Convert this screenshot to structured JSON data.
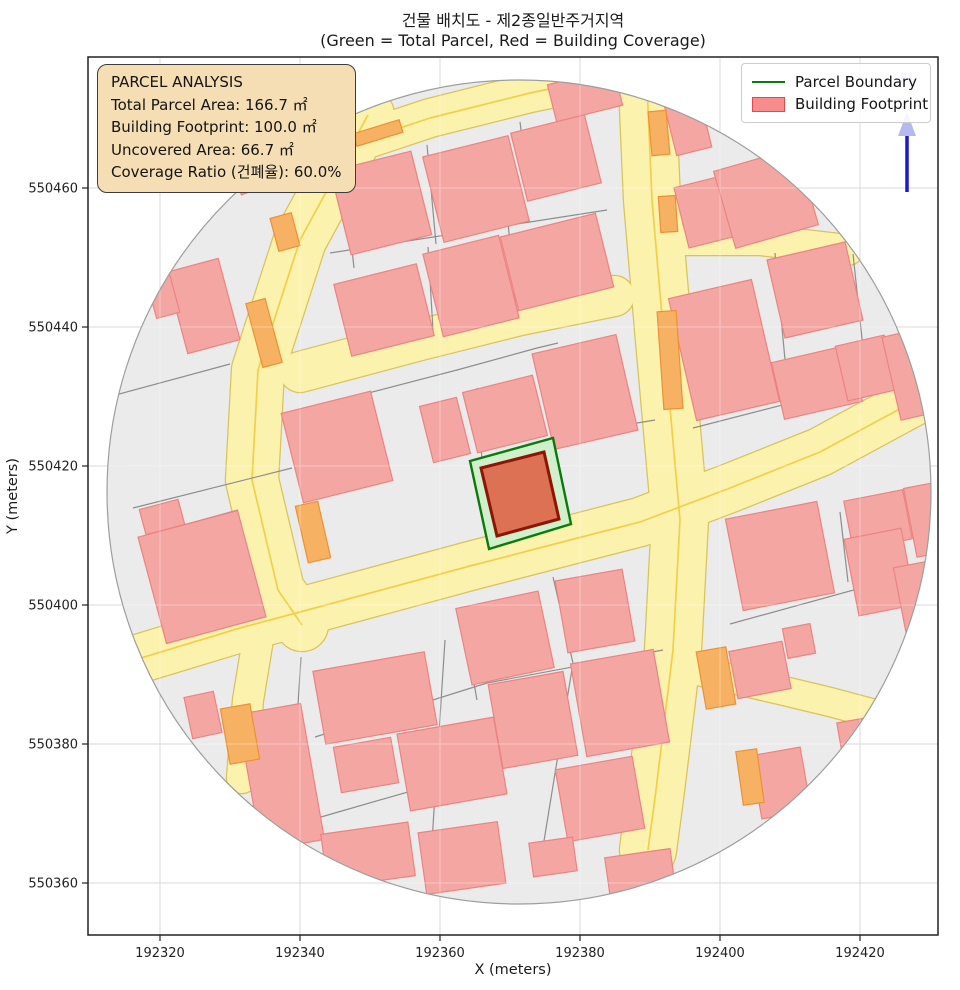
{
  "title": {
    "line1": "건물 배치도 - 제2종일반주거지역",
    "line2": "(Green = Total Parcel, Red = Building Coverage)"
  },
  "info_box": {
    "lines": [
      "PARCEL ANALYSIS",
      "Total Parcel Area: 166.7 ㎡",
      "Building Footprint: 100.0 ㎡",
      "Uncovered Area: 66.7 ㎡",
      "Coverage Ratio (건폐율): 60.0%"
    ]
  },
  "legend": {
    "items": [
      {
        "label": "Parcel Boundary",
        "type": "line",
        "color": "#0a7d0a"
      },
      {
        "label": "Building Footprint",
        "type": "patch",
        "fill": "#f88b8b",
        "stroke": "#e04b4b"
      }
    ]
  },
  "axes": {
    "xlabel": "X (meters)",
    "ylabel": "Y (meters)",
    "x_ticks": [
      192320,
      192340,
      192360,
      192380,
      192400,
      192420
    ],
    "y_ticks": [
      550360,
      550380,
      550400,
      550420,
      550440,
      550460
    ]
  },
  "north": {
    "label": "N"
  },
  "chart_data": {
    "type": "map",
    "title": "건물 배치도 - 제2종일반주거지역",
    "subtitle": "(Green = Total Parcel, Red = Building Coverage)",
    "xlabel": "X (meters)",
    "ylabel": "Y (meters)",
    "x_range": [
      192310,
      192431
    ],
    "y_range": [
      550353,
      550479
    ],
    "grid": true,
    "legend_position": "upper right",
    "zoning": "제2종일반주거지역",
    "parcel_analysis": {
      "total_parcel_area_m2": 166.7,
      "building_footprint_m2": 100.0,
      "uncovered_area_m2": 66.7,
      "coverage_ratio_pct": 60.0
    },
    "layers": [
      "buffer circle",
      "roads",
      "cadastral parcels",
      "building footprints",
      "highlighted parcel (green)",
      "highlighted building (red)",
      "north arrow"
    ]
  },
  "map": {
    "colors": {
      "circle_fill": "#ebebeb",
      "circle_edge": "#9e9e9e",
      "road_fill": "#fbf2ad",
      "road_edge": "#d9c35b",
      "road_centerline": "#f3cf49",
      "parcel_line": "#8d8d8d",
      "building_fill": "#f4a6a3",
      "building_edge": "#ec8381",
      "orange_fill": "#f7b163",
      "orange_edge": "#ec9134",
      "parcel_green_fill": "#cff0cb",
      "parcel_green_edge": "#0b7a0b",
      "footprint_fill": "#dc7154",
      "footprint_edge": "#8e1506",
      "grid": "#d9d9d9",
      "north_arrow": "#1a1acc",
      "north_text": "#b4baee",
      "spine": "#222222"
    },
    "circle": {
      "cx": 519,
      "cy": 492,
      "r": 412
    },
    "roads": [
      {
        "w": 38,
        "pts": [
          [
            340,
            148
          ],
          [
            430,
            118
          ],
          [
            530,
            93
          ],
          [
            640,
            70
          ]
        ]
      },
      {
        "w": 52,
        "pts": [
          [
            368,
            115
          ],
          [
            300,
            240
          ],
          [
            258,
            370
          ],
          [
            252,
            480
          ],
          [
            278,
            590
          ],
          [
            302,
            625
          ]
        ]
      },
      {
        "w": 30,
        "pts": [
          [
            262,
            615
          ],
          [
            248,
            700
          ],
          [
            242,
            778
          ]
        ]
      },
      {
        "w": 56,
        "pts": [
          [
            646,
            62
          ],
          [
            652,
            200
          ],
          [
            664,
            340
          ],
          [
            680,
            520
          ],
          [
            673,
            650
          ],
          [
            656,
            790
          ],
          [
            648,
            850
          ]
        ]
      },
      {
        "w": 48,
        "pts": [
          [
            108,
            668
          ],
          [
            240,
            628
          ],
          [
            300,
            612
          ],
          [
            470,
            566
          ],
          [
            570,
            540
          ],
          [
            640,
            522
          ],
          [
            730,
            488
          ],
          [
            820,
            452
          ],
          [
            920,
            398
          ]
        ]
      },
      {
        "w": 30,
        "pts": [
          [
            676,
            240
          ],
          [
            760,
            240
          ],
          [
            848,
            250
          ]
        ]
      },
      {
        "w": 28,
        "pts": [
          [
            685,
            668
          ],
          [
            780,
            690
          ],
          [
            830,
            702
          ],
          [
            905,
            722
          ]
        ]
      },
      {
        "w": 40,
        "pts": [
          [
            300,
            372
          ],
          [
            420,
            340
          ],
          [
            520,
            315
          ],
          [
            614,
            296
          ]
        ]
      }
    ],
    "centerlines": [
      {
        "pts": [
          [
            108,
            668
          ],
          [
            240,
            628
          ],
          [
            300,
            612
          ],
          [
            470,
            566
          ],
          [
            570,
            540
          ],
          [
            640,
            522
          ],
          [
            730,
            488
          ],
          [
            820,
            452
          ],
          [
            920,
            398
          ]
        ]
      },
      {
        "pts": [
          [
            646,
            62
          ],
          [
            652,
            200
          ],
          [
            664,
            340
          ],
          [
            680,
            520
          ],
          [
            673,
            650
          ],
          [
            656,
            790
          ],
          [
            648,
            850
          ]
        ]
      },
      {
        "pts": [
          [
            368,
            115
          ],
          [
            300,
            240
          ],
          [
            258,
            370
          ],
          [
            252,
            480
          ],
          [
            278,
            590
          ],
          [
            302,
            625
          ]
        ]
      },
      {
        "pts": [
          [
            340,
            148
          ],
          [
            430,
            118
          ],
          [
            530,
            93
          ],
          [
            640,
            70
          ]
        ]
      }
    ],
    "parcel_lines": [
      [
        [
          133,
          508
        ],
        [
          292,
          468
        ]
      ],
      [
        [
          112,
          396
        ],
        [
          230,
          364
        ]
      ],
      [
        [
          345,
          183
        ],
        [
          354,
          268
        ]
      ],
      [
        [
          427,
          145
        ],
        [
          436,
          244
        ]
      ],
      [
        [
          520,
          122
        ],
        [
          530,
          200
        ]
      ],
      [
        [
          330,
          253
        ],
        [
          607,
          210
        ]
      ],
      [
        [
          428,
          247
        ],
        [
          433,
          330
        ]
      ],
      [
        [
          508,
          222
        ],
        [
          516,
          312
        ]
      ],
      [
        [
          295,
          412
        ],
        [
          457,
          370
        ],
        [
          537,
          348
        ],
        [
          558,
          343
        ]
      ],
      [
        [
          553,
          437
        ],
        [
          655,
          420
        ]
      ],
      [
        [
          477,
          388
        ],
        [
          482,
          460
        ]
      ],
      [
        [
          775,
          253
        ],
        [
          790,
          413
        ]
      ],
      [
        [
          853,
          254
        ],
        [
          863,
          348
        ]
      ],
      [
        [
          693,
          428
        ],
        [
          860,
          385
        ]
      ],
      [
        [
          730,
          624
        ],
        [
          890,
          580
        ]
      ],
      [
        [
          840,
          512
        ],
        [
          848,
          582
        ]
      ],
      [
        [
          695,
          212
        ],
        [
          880,
          176
        ]
      ],
      [
        [
          301,
          657
        ],
        [
          288,
          864
        ]
      ],
      [
        [
          445,
          640
        ],
        [
          431,
          857
        ]
      ],
      [
        [
          553,
          577
        ],
        [
          573,
          663
        ],
        [
          543,
          847
        ]
      ],
      [
        [
          315,
          737
        ],
        [
          487,
          683
        ],
        [
          663,
          650
        ]
      ],
      [
        [
          321,
          817
        ],
        [
          505,
          764
        ],
        [
          558,
          750
        ]
      ],
      [
        [
          462,
          617
        ],
        [
          477,
          700
        ]
      ],
      [
        [
          140,
          537
        ],
        [
          238,
          510
        ]
      ]
    ],
    "buildings": [
      [
        260,
        170,
        52,
        34,
        -20
      ],
      [
        203,
        306,
        54,
        84,
        -15
      ],
      [
        163,
        296,
        24,
        40,
        -15
      ],
      [
        381,
        203,
        83,
        86,
        -14
      ],
      [
        476,
        189,
        88,
        88,
        -14
      ],
      [
        556,
        158,
        76,
        70,
        -14
      ],
      [
        585,
        95,
        68,
        38,
        -14
      ],
      [
        688,
        126,
        36,
        52,
        -14
      ],
      [
        590,
        66,
        50,
        14,
        -14
      ],
      [
        384,
        310,
        85,
        74,
        -14
      ],
      [
        471,
        286,
        78,
        85,
        -14
      ],
      [
        557,
        262,
        98,
        76,
        -14
      ],
      [
        337,
        447,
        92,
        92,
        -14
      ],
      [
        445,
        430,
        38,
        58,
        -14
      ],
      [
        505,
        414,
        72,
        62,
        -14
      ],
      [
        585,
        392,
        86,
        98,
        -13
      ],
      [
        713,
        210,
        65,
        62,
        -14
      ],
      [
        766,
        198,
        86,
        80,
        -16
      ],
      [
        724,
        350,
        85,
        125,
        -13
      ],
      [
        815,
        290,
        80,
        80,
        -13
      ],
      [
        817,
        382,
        80,
        58,
        -13
      ],
      [
        866,
        368,
        50,
        56,
        -13
      ],
      [
        908,
        375,
        34,
        85,
        -13
      ],
      [
        878,
        520,
        60,
        50,
        -11
      ],
      [
        925,
        520,
        30,
        70,
        -11
      ],
      [
        780,
        556,
        93,
        93,
        -11
      ],
      [
        880,
        572,
        58,
        78,
        -11
      ],
      [
        799,
        641,
        28,
        30,
        -11
      ],
      [
        760,
        670,
        54,
        48,
        -11
      ],
      [
        917,
        600,
        34,
        72,
        -11
      ],
      [
        781,
        783,
        50,
        64,
        -10
      ],
      [
        862,
        745,
        42,
        52,
        -10
      ],
      [
        162,
        517,
        40,
        26,
        -15
      ],
      [
        202,
        577,
        103,
        110,
        -15
      ],
      [
        203,
        715,
        30,
        42,
        -12
      ],
      [
        281,
        777,
        64,
        138,
        -10
      ],
      [
        375,
        698,
        113,
        74,
        -10
      ],
      [
        366,
        765,
        58,
        46,
        -10
      ],
      [
        452,
        764,
        98,
        78,
        -10
      ],
      [
        368,
        855,
        88,
        54,
        -8
      ],
      [
        462,
        858,
        80,
        62,
        -8
      ],
      [
        505,
        638,
        84,
        78,
        -12
      ],
      [
        533,
        720,
        76,
        85,
        -10
      ],
      [
        595,
        611,
        68,
        73,
        -10
      ],
      [
        620,
        703,
        84,
        94,
        -10
      ],
      [
        600,
        799,
        78,
        73,
        -10
      ],
      [
        553,
        857,
        44,
        34,
        -8
      ],
      [
        640,
        872,
        66,
        38,
        -8
      ]
    ],
    "orange_buildings": [
      [
        285,
        232,
        22,
        34,
        -15
      ],
      [
        264,
        333,
        20,
        66,
        -15
      ],
      [
        313,
        532,
        23,
        58,
        -13
      ],
      [
        659,
        133,
        18,
        44,
        -5
      ],
      [
        670,
        360,
        19,
        98,
        -4
      ],
      [
        668,
        214,
        17,
        36,
        -4
      ],
      [
        716,
        678,
        30,
        58,
        -10
      ],
      [
        750,
        777,
        21,
        54,
        -8
      ],
      [
        240,
        734,
        30,
        56,
        -10
      ],
      [
        378,
        133,
        48,
        13,
        -17
      ]
    ],
    "highlight_parcel": {
      "points": [
        [
          470,
          461
        ],
        [
          553,
          438
        ],
        [
          571,
          524
        ],
        [
          489,
          549
        ]
      ]
    },
    "highlight_building": {
      "points": [
        [
          481,
          468
        ],
        [
          544,
          452
        ],
        [
          559,
          519
        ],
        [
          497,
          536
        ]
      ]
    },
    "north_arrow": {
      "x": 907,
      "y_top": 112,
      "y_bottom": 192,
      "label_y": 84
    }
  }
}
